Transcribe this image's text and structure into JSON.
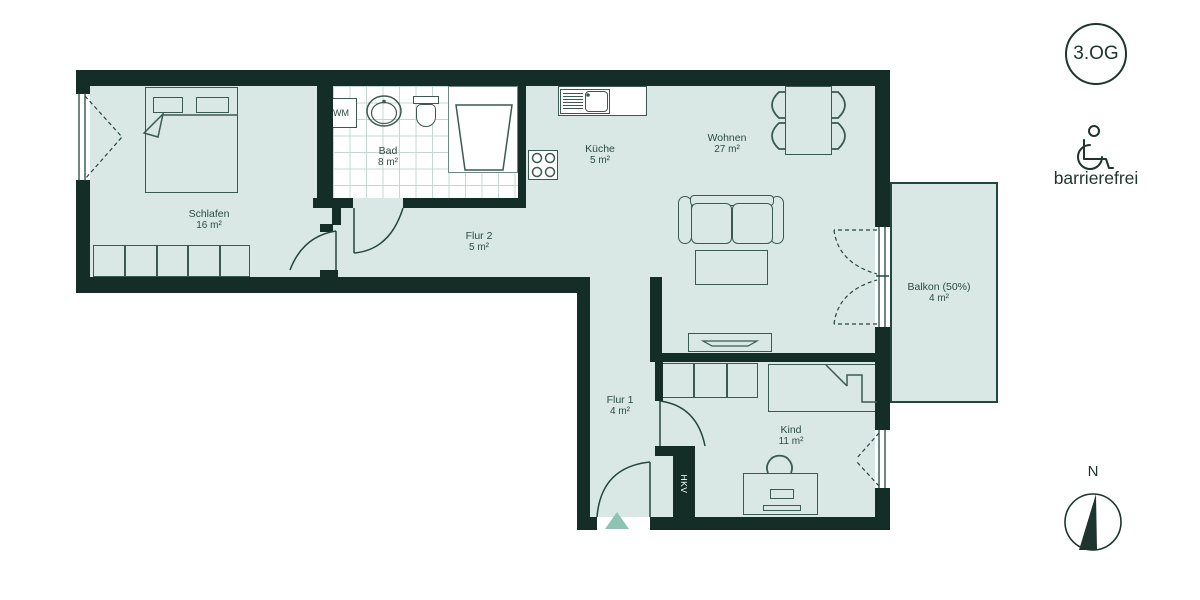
{
  "plan": {
    "rooms": {
      "schlafen": {
        "name": "Schlafen",
        "area": "16 m²"
      },
      "bad": {
        "name": "Bad",
        "area": "8 m²"
      },
      "kueche": {
        "name": "Küche",
        "area": "5 m²"
      },
      "wohnen": {
        "name": "Wohnen",
        "area": "27 m²"
      },
      "flur2": {
        "name": "Flur 2",
        "area": "5 m²"
      },
      "flur1": {
        "name": "Flur 1",
        "area": "4 m²"
      },
      "kind": {
        "name": "Kind",
        "area": "11 m²"
      },
      "balkon": {
        "name": "Balkon (50%)",
        "area": "4 m²"
      }
    },
    "fixtures": {
      "washing_machine": "WM",
      "heating_shaft": "HKV"
    },
    "badges": {
      "floor": "3.OG",
      "accessibility": "barrierefrei",
      "compass_north": "N"
    },
    "colors": {
      "wall": "#142e27",
      "floor_fill": "#d9e8e5",
      "entrance_accent": "#8cc3b4",
      "text": "#2c4b42"
    }
  }
}
